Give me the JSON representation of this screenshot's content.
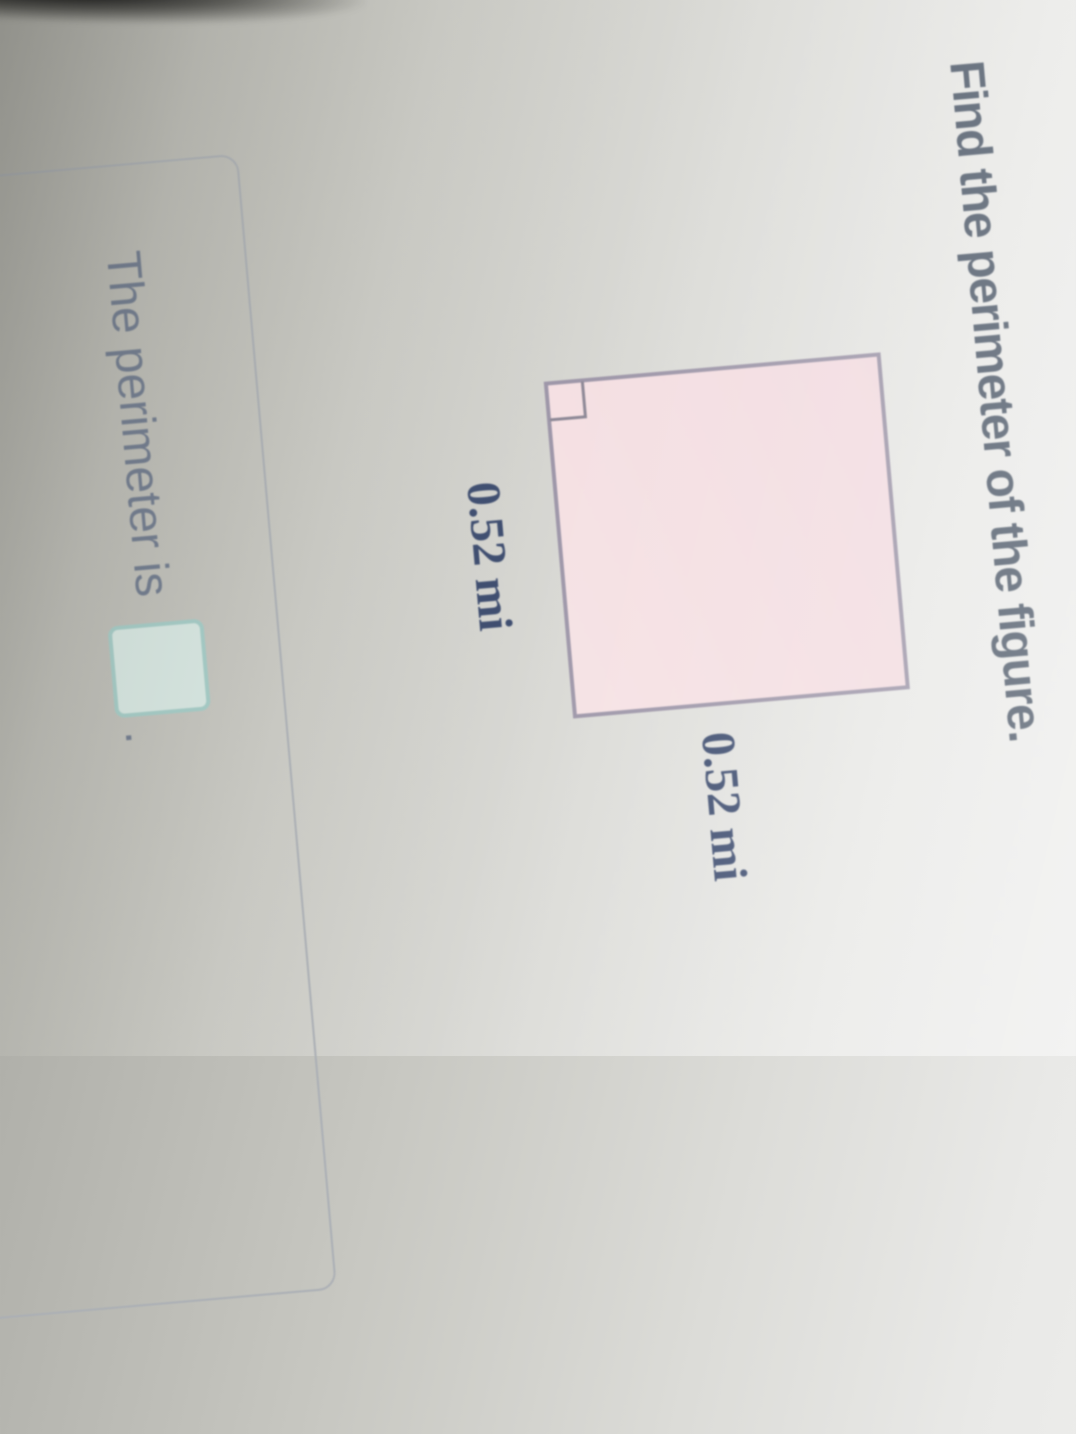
{
  "problem": {
    "heading": "Find the perimeter of the figure.",
    "figure": {
      "shape": "square",
      "has_right_angle_marker": true,
      "side_label_bottom": "0.52 mi",
      "side_label_right": "0.52 mi",
      "unit": "mi"
    },
    "answer": {
      "prefix": "The perimeter is",
      "suffix": ".",
      "input_value": ""
    }
  },
  "colors": {
    "background_shadow": "#b0b0aa",
    "background_light": "#efefed",
    "heading_text": "#515c6b",
    "figure_fill": "#f3dee2",
    "figure_stroke": "#9e97a9",
    "measurement_text": "#3f4e70",
    "answer_text": "#6f7a8e",
    "answer_box_fill": "#d9e9e4",
    "answer_box_border": "#a5cdc8",
    "panel_border": "#abafb5"
  }
}
